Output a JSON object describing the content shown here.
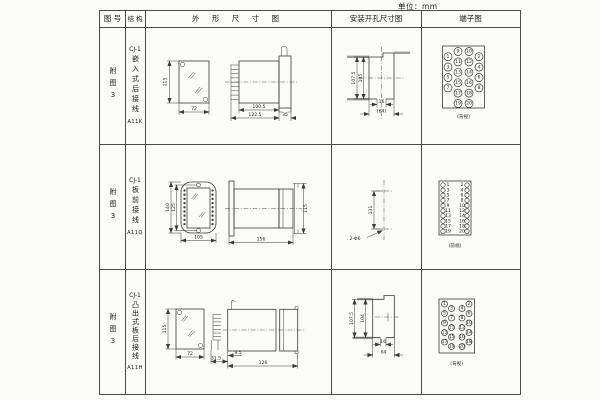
{
  "unit_label": "单位：mm",
  "table": {
    "headers": {
      "figure_no": "图 号",
      "structure": "结 构",
      "outline": "外 形 尺 寸 图",
      "install": "安装开孔尺寸图",
      "terminal": "端子图"
    },
    "rows": [
      {
        "figure_no": "附图3",
        "series": "CJ-1",
        "structure": "嵌入式后接线",
        "model": "A11K",
        "view_label": "(背视)",
        "dims": {
          "front_h": "115",
          "front_w": "72",
          "body_l": "100.5",
          "overall_l": "122.5",
          "flange_w": "35",
          "cut_h1": "107.5",
          "cut_h2": "105",
          "slot_w": "16",
          "cut_w": "(64)"
        }
      },
      {
        "figure_no": "附图3",
        "series": "CJ-1",
        "structure": "板前接线",
        "model": "A11Q",
        "view_label": "(前视)",
        "dims": {
          "front_h1": "140",
          "front_h2": "125",
          "front_w": "105",
          "overall_l": "156",
          "side_h": "115",
          "hole_dist": "131",
          "hole_note": "2-Φ6"
        }
      },
      {
        "figure_no": "附图3",
        "series": "CJ-1",
        "structure": "凸出式板后接线",
        "model": "A11H",
        "view_label": "(背视)",
        "dims": {
          "front_h": "115",
          "front_w": "72",
          "pin_l": "31.5",
          "gap": "9.5",
          "overall_l": "126",
          "cut_h1": "107.5",
          "cut_h2": "104",
          "slot_w": "16",
          "cut_w": "64"
        }
      }
    ]
  },
  "terminals": {
    "row1": {
      "r": 4,
      "label_size": 3.2,
      "columns": [
        {
          "x": 27,
          "ys": [
            29.7,
            40.1,
            50.5,
            60.9
          ],
          "labels": [
            "1",
            "3",
            "5",
            "7"
          ]
        },
        {
          "x": 37,
          "ys": [
            24.5,
            34.9,
            45.3,
            55.7,
            66.1,
            76.5
          ],
          "labels": [
            "9",
            "11",
            "13",
            "15",
            "17",
            "19"
          ]
        },
        {
          "x": 48,
          "ys": [
            24.5,
            34.9,
            45.3,
            55.7,
            66.1,
            76.5
          ],
          "labels": [
            "10",
            "12",
            "14",
            "16",
            "18",
            "20"
          ]
        },
        {
          "x": 58,
          "ys": [
            29.7,
            40.1,
            50.5,
            60.9
          ],
          "labels": [
            "2",
            "4",
            "6",
            "8"
          ]
        }
      ]
    },
    "row2": {
      "r": 2.2,
      "label_size": 3.4,
      "columns": [
        {
          "x": 22,
          "label_x": 27,
          "ys": [
            41,
            46.2,
            51.3,
            56.5,
            61.6,
            66.8,
            71.9,
            77.1,
            82.2,
            87.4
          ],
          "labels": [
            "1",
            "3",
            "5",
            "7",
            "9",
            "11",
            "13",
            "15",
            "17",
            "19"
          ]
        },
        {
          "x": 46,
          "label_x": 41,
          "ys": [
            41,
            46.2,
            51.3,
            56.5,
            61.6,
            66.8,
            71.9,
            77.1,
            82.2,
            87.4
          ],
          "labels": [
            "2",
            "4",
            "6",
            "8",
            "10",
            "12",
            "14",
            "16",
            "18",
            "20"
          ]
        }
      ]
    },
    "row3": {
      "r": 3,
      "label_size": 2.8,
      "columns": [
        {
          "x": 23.5,
          "ys": [
            35,
            44.5,
            54,
            63.5,
            73
          ],
          "labels": [
            "1",
            "5",
            "9",
            "13",
            "17"
          ]
        },
        {
          "x": 30.5,
          "ys": [
            39.5,
            49,
            58.5,
            68,
            77.5
          ],
          "labels": [
            "3",
            "7",
            "11",
            "15",
            "19"
          ]
        },
        {
          "x": 41,
          "ys": [
            39.5,
            49,
            58.5,
            68,
            77.5
          ],
          "labels": [
            "4",
            "8",
            "12",
            "16",
            "20"
          ]
        },
        {
          "x": 48,
          "ys": [
            35,
            44.5,
            54,
            63.5,
            73
          ],
          "labels": [
            "2",
            "6",
            "10",
            "14",
            "18"
          ]
        }
      ]
    }
  }
}
